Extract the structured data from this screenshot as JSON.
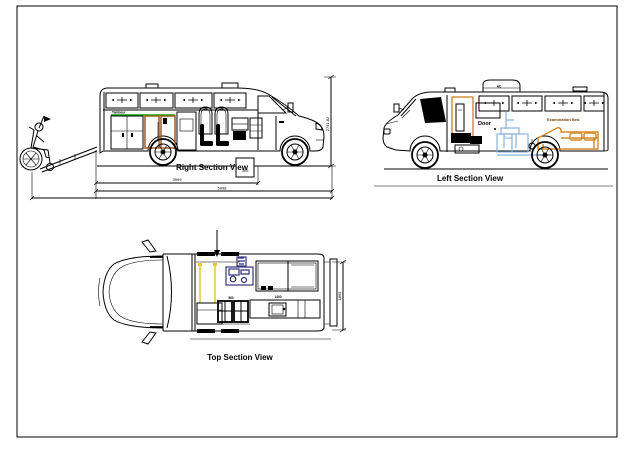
{
  "sheet": {
    "views": {
      "right": {
        "title": "Right Section View",
        "cabinet_label": "Tambour",
        "dim_inner": "3999",
        "dim_outer": "5998",
        "dim_box": "300",
        "dim_height": "2741.82"
      },
      "left": {
        "title": "Left Section View",
        "roof_unit_label": "AC",
        "door_label": "Door",
        "bed_label": "Examination Bed",
        "chair_label": "Chair"
      },
      "top": {
        "title": "Top Section View",
        "dim_height": "1865",
        "seat_dim": "960",
        "counter_dim": "1400"
      }
    },
    "colors": {
      "green": "#00a800",
      "brown": "#a05a28",
      "orange": "#d4882a",
      "blue": "#8ab0dc",
      "navy": "#32327d",
      "yellow": "#e6c832"
    }
  }
}
